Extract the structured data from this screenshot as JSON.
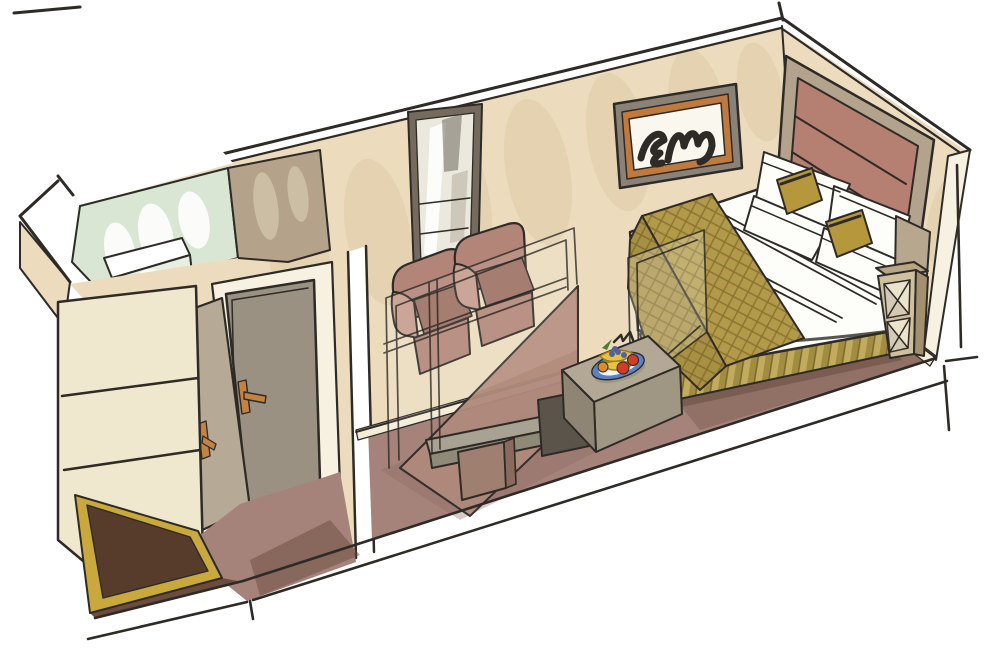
{
  "meta": {
    "title": "Hand-drawn cutaway perspective illustration of a cabin stateroom interior",
    "style": "marker-and-ink architectural sketch",
    "canvas": {
      "width": 1000,
      "height": 664
    }
  },
  "scene": {
    "rooms": [
      "bathroom with glass shower",
      "entry vestibule with wardrobe",
      "sitting area",
      "bedroom"
    ],
    "objects": [
      "shower enclosure",
      "entry door",
      "closet door",
      "door mat",
      "wardrobe",
      "wall mirror",
      "two armchairs",
      "sectioned tv-console wall",
      "desk pedestal",
      "side table with fruit plate",
      "double bed",
      "pillows",
      "gold accent cushions",
      "patterned bed runner",
      "pleated bed skirt",
      "upholstered headboard",
      "framed abstract artwork",
      "bedside open shelf unit"
    ]
  },
  "palette": {
    "ink": "#2e2b27",
    "paper": "#ffffff",
    "wall_beige": "#ecdcbd",
    "arch_shade": "#dcc9a4",
    "cream_band": "#f7f1e2",
    "baseboard": "#f3ecd8",
    "glass_green": "#d8e6d3",
    "glass_light": "#e6efe1",
    "bath_wall": "#b4a28b",
    "bath_wall_light": "#cfc0a8",
    "door_gray": "#9a9182",
    "closet_door": "#b6a995",
    "handle_copper": "#c5833f",
    "wardrobe_cream": "#f0e7cf",
    "wardrobe_shade": "#d8c9a6",
    "carpet": "#a5837a",
    "carpet_dark": "#8c6b60",
    "carpet_deep": "#6b4c3d",
    "mat_brown": "#573c2c",
    "mat_gold": "#c9a93c",
    "chair": "#b28578",
    "chair_dark": "#9c6f62",
    "chair_light": "#c59c8d",
    "mirror_frame": "#746b5e",
    "mirror_glass": "#ebe8dd",
    "mirror_streak": "#6e675e",
    "section_mauve": "#b08a7c",
    "console_top": "#a8a293",
    "console_front": "#8f8a78",
    "pedestal": "#9f7f70",
    "pedestal_side": "#8a6a5c",
    "cubby": "#5a544b",
    "table_top": "#b2a895",
    "table_front": "#a09684",
    "table_side": "#8f8574",
    "plate_blue": "#5b82c4",
    "plate_white": "#f2f4f6",
    "banana": "#e8c23e",
    "banana_line": "#9c7b1c",
    "apple": "#cf3d28",
    "grape": "#55619f",
    "leaf": "#4e7d35",
    "orange_fruit": "#e08a2e",
    "bed_white": "#fdfdfa",
    "bed_shade": "#d9d8cf",
    "stitch": "#b6bdc4",
    "cushion_gold": "#b5973c",
    "cushion_light": "#d3b968",
    "runner": "#b29a4a",
    "runner_line": "#8a7430",
    "skirt_a": "#a28c3f",
    "skirt_b": "#c2ab5f",
    "skirt_dark": "#7c6a2e",
    "headboard": "#b57f71",
    "headboard_seam": "#99675a",
    "headboard_frame": "#b3a28c",
    "headboard_edge": "#8e4f41",
    "art_frame": "#8a8276",
    "art_mat": "#c07a3e",
    "art_canvas": "#faf7ef",
    "art_gold": "#dcbf6e",
    "art_gold_line": "#a98f3c",
    "shelf_front": "#cfc0a0",
    "shelf_side": "#a3906f",
    "shelf_top": "#b7a584",
    "shelf_box": "#ece3cc",
    "shelf_shadow": "#8a7b64",
    "pillar": "#b8a78f",
    "ghost_line": "#3c3833",
    "shadow_dark": "#5f4638",
    "door_shadow": "#6e665b"
  }
}
